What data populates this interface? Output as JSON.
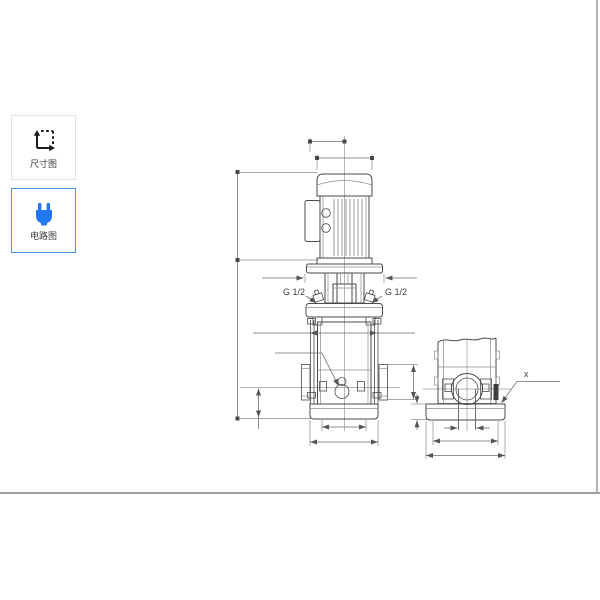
{
  "sidebar": {
    "items": [
      {
        "id": "dimension-drawing",
        "label": "尺寸图",
        "icon": "dimension-arrows-icon",
        "selected": false
      },
      {
        "id": "circuit-drawing",
        "label": "电路图",
        "icon": "power-plug-icon",
        "selected": true
      }
    ]
  },
  "drawing": {
    "type": "pump-dimensional-drawing",
    "views": [
      "front-view",
      "side-view"
    ],
    "labels": {
      "port_left": "G 1/2",
      "port_right": "G 1/2",
      "base_corner": "x"
    }
  },
  "colors": {
    "accent_border": "#4a90e2",
    "plug_icon": "#2277f2",
    "drawing_outline": "#4a4a4a",
    "dimension_line": "#6e6e6e",
    "page_border": "#9e9e9e"
  }
}
